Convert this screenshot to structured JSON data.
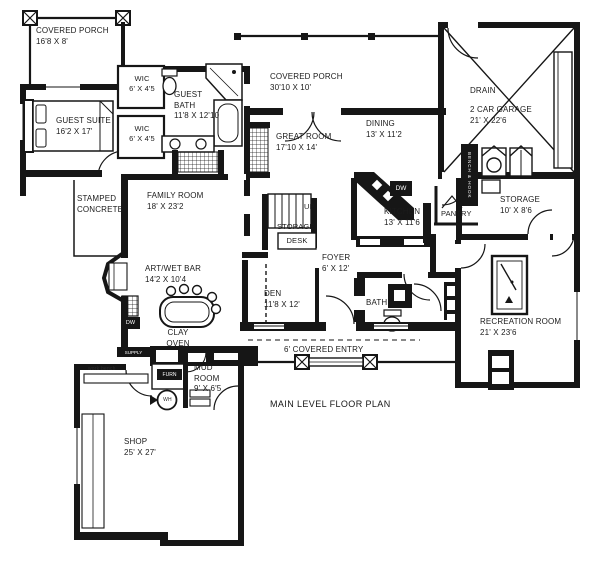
{
  "title": "MAIN LEVEL FLOOR PLAN",
  "rooms": {
    "covered_porch_nw": {
      "name": "COVERED PORCH",
      "dims": "16'8 X 8'"
    },
    "guest_suite": {
      "name": "GUEST SUITE",
      "dims": "16'2 X 17'"
    },
    "wic_upper": {
      "name": "WIC",
      "dims": "6' X 4'5"
    },
    "wic_lower": {
      "name": "WIC",
      "dims": "6' X 4'5"
    },
    "guest_bath": {
      "name": "GUEST BATH",
      "dims": "11'8 X 12'10"
    },
    "covered_porch_north": {
      "name": "COVERED PORCH",
      "dims": "30'10 X 10'"
    },
    "great_room": {
      "name": "GREAT ROOM",
      "dims": "17'10 X 14'"
    },
    "dining": {
      "name": "DINING",
      "dims": "13' X 11'2"
    },
    "garage": {
      "name": "2 CAR GARAGE",
      "dims": "21' X 22'6"
    },
    "garage_drain": {
      "name": "DRAIN"
    },
    "storage_upper": {
      "name": "STORAGE",
      "dims": "10' X 8'6"
    },
    "kitchen": {
      "name": "KITCHEN",
      "dims": "13' X 11'6"
    },
    "pantry": {
      "name": "PANTRY"
    },
    "stamped_concrete": {
      "line1": "STAMPED",
      "line2": "CONCRETE"
    },
    "family_room": {
      "name": "FAMILY ROOM",
      "dims": "18' X 23'2"
    },
    "stair_direction": {
      "name": "UP"
    },
    "stair_storage": {
      "name": "STORAGE"
    },
    "desk": {
      "name": "DESK"
    },
    "foyer": {
      "name": "FOYER",
      "dims": "6' X 12'"
    },
    "den": {
      "name": "DEN",
      "dims": "11'8 X 12'"
    },
    "bath": {
      "name": "BATH"
    },
    "art_wet_bar": {
      "name": "ART/WET BAR",
      "dims": "14'2 X 10'4"
    },
    "clay_oven": {
      "line1": "CLAY",
      "line2": "OVEN"
    },
    "mud_room": {
      "name": "MUD ROOM",
      "dims": "9' X 6'5"
    },
    "recreation_room": {
      "name": "RECREATION ROOM",
      "dims": "21' X 23'6"
    },
    "shop": {
      "name": "SHOP",
      "dims": "25' X 27'"
    },
    "covered_entry": {
      "name": "6' COVERED ENTRY"
    }
  },
  "fixtures": {
    "dw_kitchen": "DW",
    "dw_bar": "DW",
    "supply": "SUPPLY",
    "furn": "FURN",
    "wh": "WH",
    "bench_hook": "BENCH & HOOK",
    "work_bench": "work bench"
  }
}
